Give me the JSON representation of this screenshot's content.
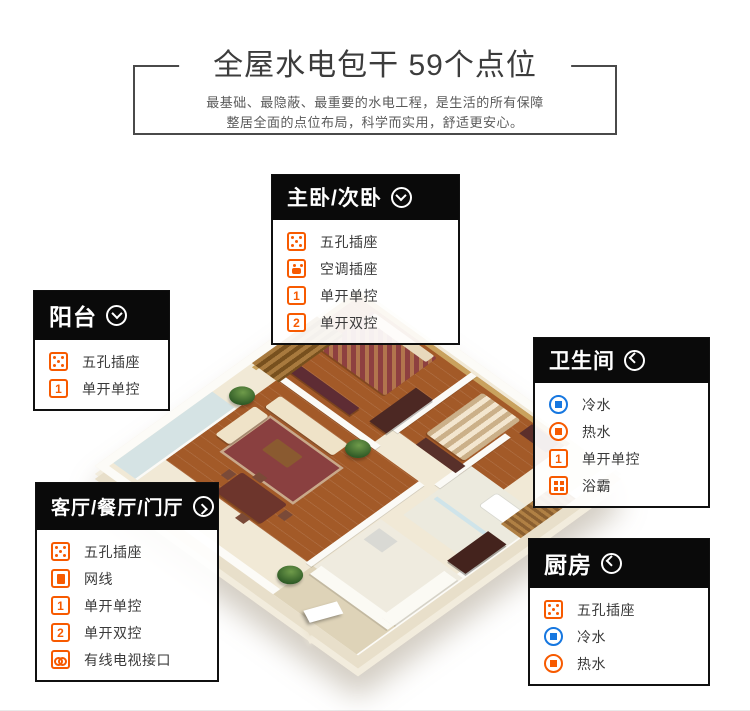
{
  "header": {
    "title": "全屋水电包干  59个点位",
    "subtitle_line1": "最基础、最隐蔽、最重要的水电工程，是生活的所有保障",
    "subtitle_line2": "整居全面的点位布局，科学而实用，舒适更安心。"
  },
  "colors": {
    "accent_orange": "#f75a00",
    "accent_blue": "#1677e0",
    "panel_header_bg": "#0a0a0a",
    "title_text": "#3c3c3c"
  },
  "panels": [
    {
      "id": "master-bedroom",
      "title": "主卧/次卧",
      "arrow_icon": "chevron-down-circle-icon",
      "items": [
        {
          "icon": "socket-5hole-icon",
          "label": "五孔插座"
        },
        {
          "icon": "socket-ac-icon",
          "label": "空调插座"
        },
        {
          "icon": "switch-single-icon",
          "badge": "1",
          "label": "单开单控"
        },
        {
          "icon": "switch-double-icon",
          "badge": "2",
          "label": "单开双控"
        }
      ]
    },
    {
      "id": "balcony",
      "title": "阳台",
      "arrow_icon": "chevron-down-circle-icon",
      "items": [
        {
          "icon": "socket-5hole-icon",
          "label": "五孔插座"
        },
        {
          "icon": "switch-single-icon",
          "badge": "1",
          "label": "单开单控"
        }
      ]
    },
    {
      "id": "bathroom",
      "title": "卫生间",
      "arrow_icon": "chevron-left-circle-icon",
      "items": [
        {
          "icon": "cold-water-icon",
          "label": "冷水"
        },
        {
          "icon": "hot-water-icon",
          "label": "热水"
        },
        {
          "icon": "switch-single-icon",
          "badge": "1",
          "label": "单开单控"
        },
        {
          "icon": "bath-heater-icon",
          "label": "浴霸"
        }
      ]
    },
    {
      "id": "living-dining-foyer",
      "title": "客厅/餐厅/门厅",
      "arrow_icon": "chevron-right-circle-icon",
      "items": [
        {
          "icon": "socket-5hole-icon",
          "label": "五孔插座"
        },
        {
          "icon": "ethernet-icon",
          "label": "网线"
        },
        {
          "icon": "switch-single-icon",
          "badge": "1",
          "label": "单开单控"
        },
        {
          "icon": "switch-double-icon",
          "badge": "2",
          "label": "单开双控"
        },
        {
          "icon": "cable-tv-icon",
          "label": "有线电视接口"
        }
      ]
    },
    {
      "id": "kitchen",
      "title": "厨房",
      "arrow_icon": "chevron-left-circle-icon",
      "items": [
        {
          "icon": "socket-5hole-icon",
          "label": "五孔插座"
        },
        {
          "icon": "cold-water-icon",
          "label": "冷水"
        },
        {
          "icon": "hot-water-icon",
          "label": "热水"
        }
      ]
    }
  ]
}
